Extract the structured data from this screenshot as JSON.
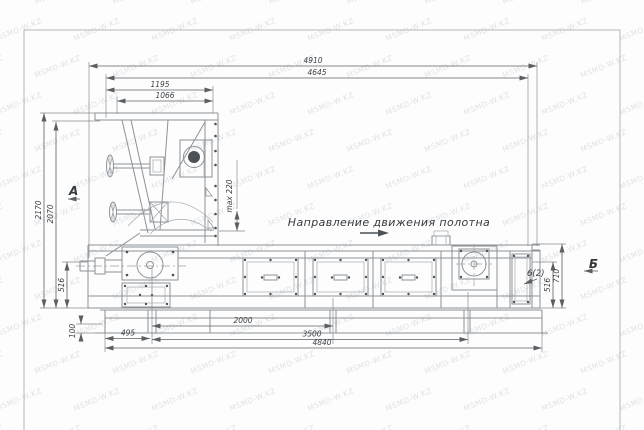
{
  "watermark": {
    "text": "MSMD-W.KZ",
    "color": "#c6cbd0"
  },
  "drawing": {
    "direction_note": "Направление движения полотна",
    "view_a": "А",
    "view_b": "Б",
    "callout": "6(2)",
    "dims": {
      "top_4910": "4910",
      "top_4645": "4645",
      "top_1195": "1195",
      "top_1066": "1066",
      "left_2170": "2170",
      "left_2070": "2070",
      "left_516": "516",
      "left_100": "100",
      "max_travel": "max 220",
      "bottom_495": "495",
      "bottom_2000": "2000",
      "bottom_3500": "3500",
      "bottom_4840": "4840",
      "right_516": "516",
      "right_710": "710"
    },
    "colors": {
      "line": "#8d9297",
      "dimension": "#5a5f64",
      "text": "#3c4146",
      "frame": "#b3b7bb",
      "background": "#fdfdfd"
    }
  }
}
